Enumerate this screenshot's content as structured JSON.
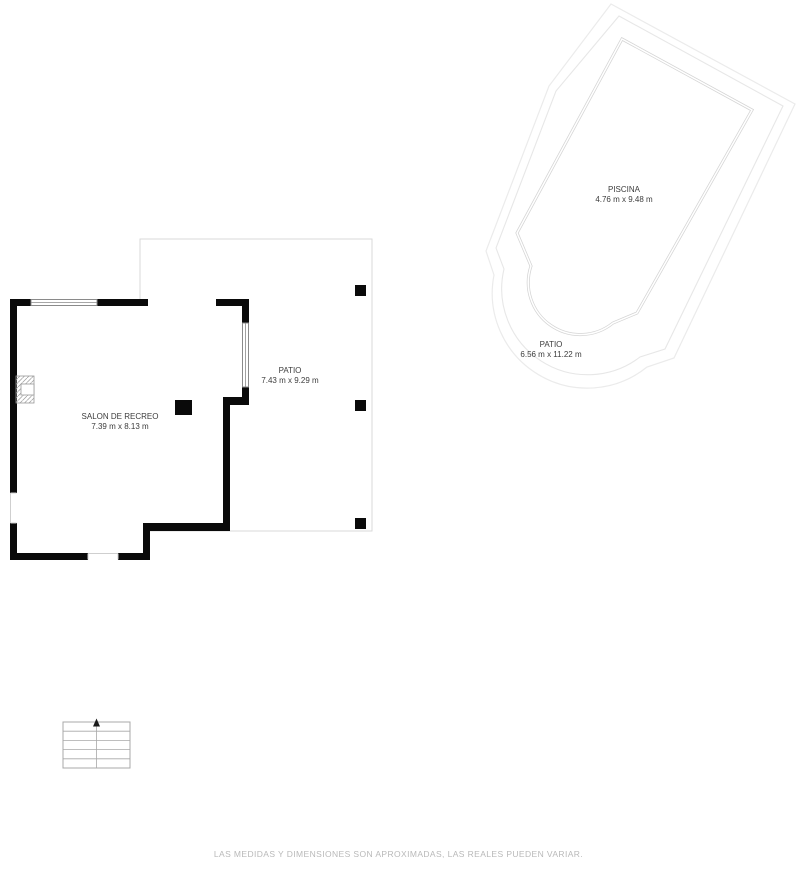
{
  "rooms": {
    "salon": {
      "name": "SALON DE RECREO",
      "dims": "7.39 m x 8.13 m"
    },
    "patio": {
      "name": "PATIO",
      "dims": "7.43 m x 9.29 m"
    },
    "piscina": {
      "name": "PISCINA",
      "dims": "4.76 m x 9.48 m"
    },
    "pool_patio": {
      "name": "PATIO",
      "dims": "6.56 m x 11.22 m"
    }
  },
  "footer": {
    "disclaimer": "LAS MEDIDAS Y DIMENSIONES SON APROXIMADAS, LAS REALES PUEDEN VARIAR."
  },
  "colors": {
    "wall": "#0a0a0a",
    "patio_line": "#d9d9d9",
    "pool_line": "#d4d4d4",
    "pool_boundary": "#ebebeb",
    "pool_boundary2": "#e7e7e7",
    "stair_line": "#a8a8a8",
    "label_text": "#3c3c3c",
    "disclaimer_text": "#b9b9b9",
    "window_line": "#8a8a8a",
    "jamb": "#cfcfcf",
    "hatch": "#9a9a9a"
  }
}
